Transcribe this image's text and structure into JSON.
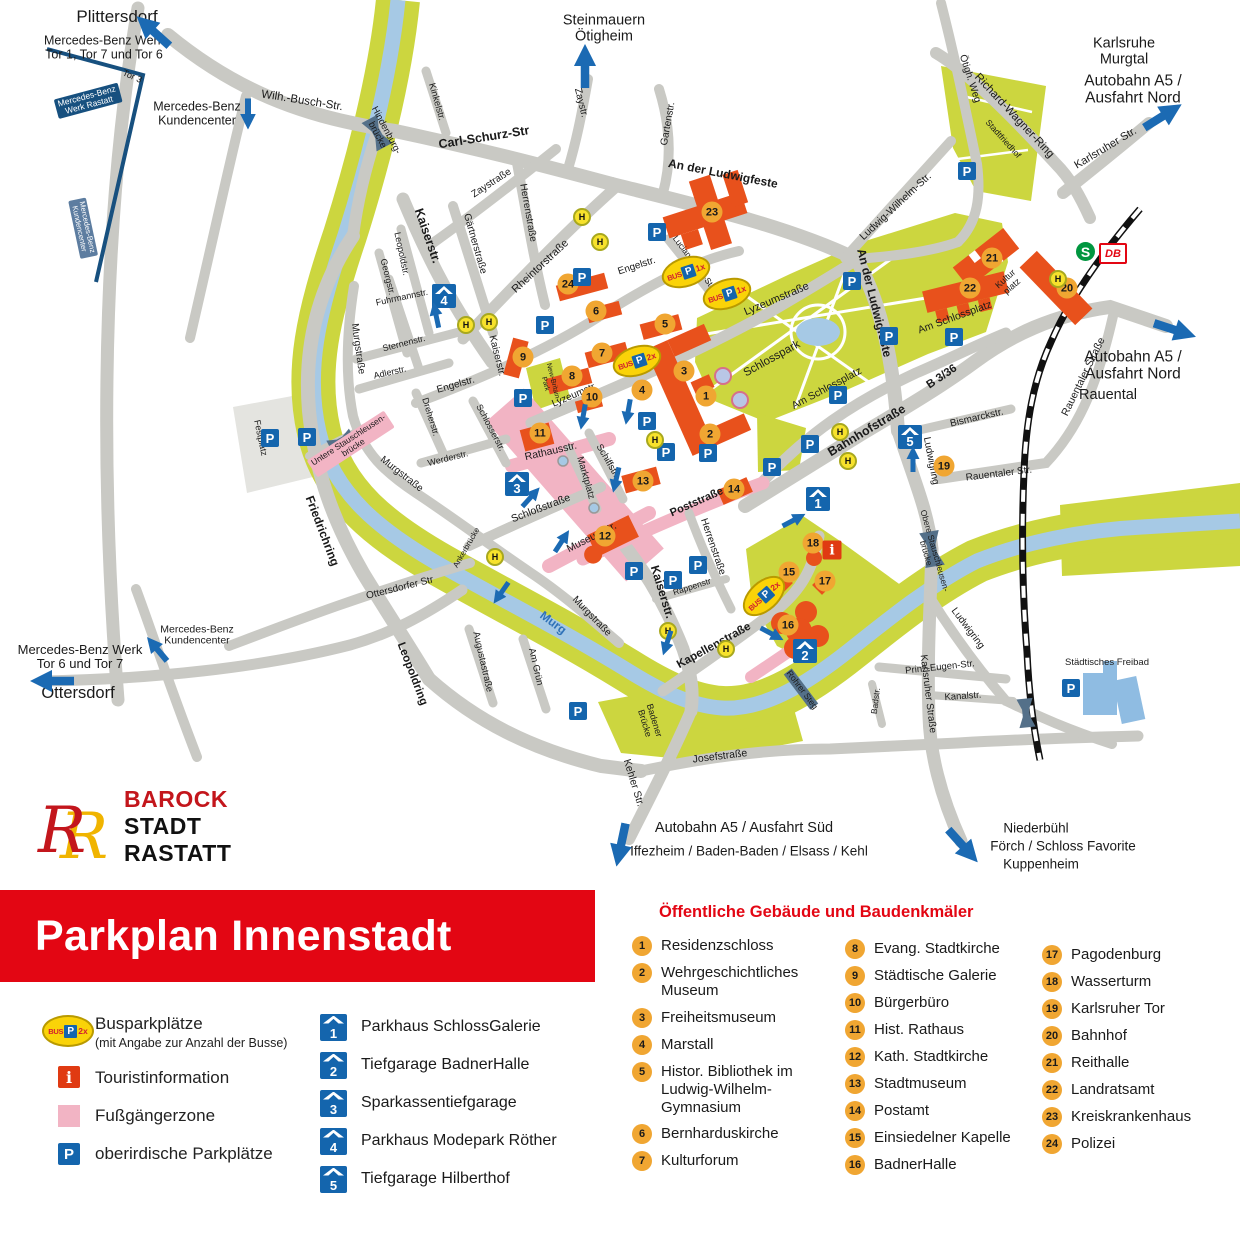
{
  "banner": {
    "title": "Parkplan Innenstadt"
  },
  "logo": {
    "line1": "BAROCK",
    "line2": "STADT",
    "line3": "RASTATT"
  },
  "legend": {
    "bus_label": "Busparkplätze",
    "bus_sub": "(mit Angabe zur Anzahl der Busse)",
    "bus_icon": {
      "bus": "BUS",
      "p": "P",
      "count": "2x"
    },
    "tourist_label": "Touristinformation",
    "tourist_glyph": "i",
    "zone_label": "Fußgängerzone",
    "parking_label": "oberirdische Parkplätze",
    "parking_glyph": "P"
  },
  "garages_legend": [
    {
      "n": "1",
      "label": "Parkhaus SchlossGalerie"
    },
    {
      "n": "2",
      "label": "Tiefgarage BadnerHalle"
    },
    {
      "n": "3",
      "label": "Sparkassentiefgarage"
    },
    {
      "n": "4",
      "label": "Parkhaus Modepark Röther"
    },
    {
      "n": "5",
      "label": "Tiefgarage Hilberthof"
    }
  ],
  "buildings": {
    "title": "Öffentliche Gebäude und Baudenkmäler",
    "col1": [
      {
        "n": "1",
        "label": "Residenzschloss"
      },
      {
        "n": "2",
        "label": "Wehrgeschichtliches Museum"
      },
      {
        "n": "3",
        "label": "Freiheitsmuseum"
      },
      {
        "n": "4",
        "label": "Marstall"
      },
      {
        "n": "5",
        "label": "Histor. Bibliothek im Ludwig-Wilhelm-Gymnasium"
      },
      {
        "n": "6",
        "label": "Bernharduskirche"
      },
      {
        "n": "7",
        "label": "Kulturforum"
      }
    ],
    "col2": [
      {
        "n": "8",
        "label": "Evang. Stadtkirche"
      },
      {
        "n": "9",
        "label": "Städtische Galerie"
      },
      {
        "n": "10",
        "label": "Bürgerbüro"
      },
      {
        "n": "11",
        "label": "Hist. Rathaus"
      },
      {
        "n": "12",
        "label": "Kath. Stadtkirche"
      },
      {
        "n": "13",
        "label": "Stadtmuseum"
      },
      {
        "n": "14",
        "label": "Postamt"
      },
      {
        "n": "15",
        "label": "Einsiedelner Kapelle"
      },
      {
        "n": "16",
        "label": "BadnerHalle"
      }
    ],
    "col3": [
      {
        "n": "17",
        "label": "Pagodenburg"
      },
      {
        "n": "18",
        "label": "Wasserturm"
      },
      {
        "n": "19",
        "label": "Karlsruher Tor"
      },
      {
        "n": "20",
        "label": "Bahnhof"
      },
      {
        "n": "21",
        "label": "Reithalle"
      },
      {
        "n": "22",
        "label": "Landratsamt"
      },
      {
        "n": "23",
        "label": "Kreiskrankenhaus"
      },
      {
        "n": "24",
        "label": "Polizei"
      }
    ]
  },
  "map": {
    "colors": {
      "road": "#c9c9c4",
      "green": "#ccd63f",
      "river": "#a6c9e5",
      "building": "#e8511c",
      "pedestrian": "#f2b4c4",
      "blue": "#1465ad",
      "poi": "#f0a632",
      "banner_red": "#e30613"
    },
    "icons": {
      "p": "P",
      "h": "H"
    },
    "transit": {
      "sbahn": "S",
      "db": "DB"
    },
    "info_icon": {
      "x": 832,
      "y": 550,
      "glyph": "i"
    },
    "labels": [
      {
        "t": "Plittersdorf",
        "x": 117,
        "y": 17,
        "s": 17
      },
      {
        "t": "Mercedes-Benz Werk\nTor 1, Tor 7 und Tor 6",
        "x": 104,
        "y": 48,
        "s": 12.5
      },
      {
        "t": "Steinmauern\nÖtigheim",
        "x": 604,
        "y": 29,
        "s": 14.5
      },
      {
        "t": "Karlsruhe\nMurgtal",
        "x": 1124,
        "y": 52,
        "s": 14.5
      },
      {
        "t": "Autobahn A5 /\nAusfahrt Nord",
        "x": 1133,
        "y": 90,
        "s": 15.5
      },
      {
        "t": "Autobahn A5 /\nAusfahrt Nord",
        "x": 1133,
        "y": 366,
        "s": 15.5
      },
      {
        "t": "Rauental",
        "x": 1108,
        "y": 396,
        "s": 14.5
      },
      {
        "t": "Mercedes-Benz\nKundencenter",
        "x": 197,
        "y": 114,
        "s": 12.5
      },
      {
        "t": "Mercedes-Benz\nKundencenter",
        "x": 197,
        "y": 636,
        "s": 10.5
      },
      {
        "t": "Mercedes-Benz Werk\nTor 6 und Tor 7",
        "x": 80,
        "y": 657,
        "s": 13
      },
      {
        "t": "Ottersdorf",
        "x": 78,
        "y": 694,
        "s": 16.5
      },
      {
        "t": "Autobahn A5 / Ausfahrt Süd",
        "x": 744,
        "y": 829,
        "s": 14.5
      },
      {
        "t": "Iffezheim / Baden-Baden / Elsass / Kehl",
        "x": 749,
        "y": 852,
        "s": 13.5
      },
      {
        "t": "Niederbühl",
        "x": 1036,
        "y": 829,
        "s": 13.5
      },
      {
        "t": "Förch / Schloss Favorite",
        "x": 1063,
        "y": 847,
        "s": 13.5
      },
      {
        "t": "Kuppenheim",
        "x": 1041,
        "y": 865,
        "s": 13.5
      },
      {
        "t": "Tor 3",
        "x": 132,
        "y": 77,
        "r": 24,
        "s": 9
      },
      {
        "t": "Mercedes-Benz\nWerk Rastatt",
        "x": 88,
        "y": 101,
        "r": -15,
        "s": 8.5,
        "c": "#fff",
        "bg": "#17507f"
      },
      {
        "t": "Mercedes-Benz\nKundencenter",
        "x": 83,
        "y": 228,
        "r": 78,
        "s": 7.5,
        "c": "#fff",
        "bg": "#5d7da0"
      },
      {
        "t": "Wilh.-Busch-Str.",
        "x": 302,
        "y": 101,
        "r": 9,
        "s": 11.5
      },
      {
        "t": "Carl-Schurz-Str",
        "x": 484,
        "y": 138,
        "r": -9,
        "s": 12.5,
        "b": 1
      },
      {
        "t": "Hindenburg-\nbrücke",
        "x": 381,
        "y": 133,
        "r": 62,
        "s": 9.5
      },
      {
        "t": "Kinkelstr.",
        "x": 436,
        "y": 102,
        "r": 74,
        "s": 9.5
      },
      {
        "t": "Zaystr.",
        "x": 580,
        "y": 103,
        "r": 76,
        "s": 10
      },
      {
        "t": "Zaystraße",
        "x": 492,
        "y": 184,
        "r": -33,
        "s": 10
      },
      {
        "t": "Gartenstr.",
        "x": 669,
        "y": 124,
        "r": -80,
        "s": 10
      },
      {
        "t": "An der Ludwigfeste",
        "x": 723,
        "y": 174,
        "r": 11,
        "s": 12,
        "b": 1
      },
      {
        "t": "An der Ludwigfeste",
        "x": 874,
        "y": 303,
        "r": 76,
        "s": 12,
        "b": 1
      },
      {
        "t": "Ludwig-Wilhelm-Str.",
        "x": 896,
        "y": 207,
        "r": -43,
        "s": 10.5
      },
      {
        "t": "Richard-Wagner-Ring",
        "x": 1014,
        "y": 116,
        "r": 47,
        "s": 11.5
      },
      {
        "t": "Ötigh. Weg",
        "x": 969,
        "y": 79,
        "r": 72,
        "s": 10
      },
      {
        "t": "Stadtfriedhof",
        "x": 1003,
        "y": 139,
        "r": 48,
        "s": 8.5
      },
      {
        "t": "Karlsruher Str.",
        "x": 1106,
        "y": 149,
        "r": -31,
        "s": 11
      },
      {
        "t": "Lyzeumstraße",
        "x": 777,
        "y": 300,
        "r": -23,
        "s": 11
      },
      {
        "t": "Lyzeumstr.",
        "x": 575,
        "y": 396,
        "r": -23,
        "s": 10
      },
      {
        "t": "Engelstr.",
        "x": 637,
        "y": 267,
        "r": -18,
        "s": 10
      },
      {
        "t": "Engelstr.",
        "x": 456,
        "y": 386,
        "r": -16,
        "s": 10
      },
      {
        "t": "Lucian-Reich-Str.",
        "x": 694,
        "y": 263,
        "r": 53,
        "s": 8.5
      },
      {
        "t": "Rheintorstraße",
        "x": 541,
        "y": 267,
        "r": -43,
        "s": 11
      },
      {
        "t": "Herrenstraße",
        "x": 527,
        "y": 213,
        "r": 80,
        "s": 10
      },
      {
        "t": "Herrenstraße",
        "x": 712,
        "y": 547,
        "r": 71,
        "s": 10
      },
      {
        "t": "Kaiserstr.",
        "x": 427,
        "y": 236,
        "r": 71,
        "s": 12.5,
        "b": 1
      },
      {
        "t": "Kaiserstr.",
        "x": 496,
        "y": 356,
        "r": 76,
        "s": 10
      },
      {
        "t": "Kaiserstr.",
        "x": 662,
        "y": 592,
        "r": 73,
        "s": 12,
        "b": 1
      },
      {
        "t": "Gärtnerstraße",
        "x": 474,
        "y": 244,
        "r": 74,
        "s": 10
      },
      {
        "t": "Leopoldstr.",
        "x": 401,
        "y": 254,
        "r": 78,
        "s": 9
      },
      {
        "t": "Georgstr.",
        "x": 387,
        "y": 277,
        "r": 76,
        "s": 9
      },
      {
        "t": "Fuhrmannstr.",
        "x": 402,
        "y": 298,
        "r": -12,
        "s": 9
      },
      {
        "t": "Sternenstr.",
        "x": 404,
        "y": 344,
        "r": -14,
        "s": 9
      },
      {
        "t": "Adlerstr.",
        "x": 390,
        "y": 373,
        "r": -13,
        "s": 9
      },
      {
        "t": "Dreherstr.",
        "x": 430,
        "y": 417,
        "r": 73,
        "s": 9
      },
      {
        "t": "Werderstr.",
        "x": 448,
        "y": 459,
        "r": -14,
        "s": 9
      },
      {
        "t": "Schlosserstr.",
        "x": 490,
        "y": 428,
        "r": 62,
        "s": 9
      },
      {
        "t": "Rathausstr.",
        "x": 551,
        "y": 452,
        "r": -13,
        "s": 10.5
      },
      {
        "t": "Marktplatz",
        "x": 585,
        "y": 478,
        "r": 74,
        "s": 9.5
      },
      {
        "t": "Schiffstr.",
        "x": 607,
        "y": 461,
        "r": 60,
        "s": 9.5
      },
      {
        "t": "Museumstr.",
        "x": 592,
        "y": 538,
        "r": -27,
        "s": 10.5
      },
      {
        "t": "Schloßstraße",
        "x": 541,
        "y": 509,
        "r": -21,
        "s": 10.5
      },
      {
        "t": "Murgstraße",
        "x": 357,
        "y": 349,
        "r": 82,
        "s": 10
      },
      {
        "t": "Murgstraße",
        "x": 401,
        "y": 475,
        "r": 38,
        "s": 10
      },
      {
        "t": "Murgstraße",
        "x": 591,
        "y": 617,
        "r": 46,
        "s": 10
      },
      {
        "t": "Murg",
        "x": 553,
        "y": 623,
        "r": 37,
        "s": 12,
        "b": 1,
        "c": "#2f72b8"
      },
      {
        "t": "Festplatz",
        "x": 260,
        "y": 438,
        "r": 78,
        "s": 9
      },
      {
        "t": "Untere Stauschleusen-\nbrücke",
        "x": 351,
        "y": 444,
        "r": -33,
        "s": 8.5,
        "bg": "#f2b4c4"
      },
      {
        "t": "Friedrichring",
        "x": 322,
        "y": 531,
        "r": 69,
        "s": 12,
        "b": 1
      },
      {
        "t": "Ottersdorfer Str",
        "x": 400,
        "y": 589,
        "r": -14,
        "s": 10
      },
      {
        "t": "Leopoldring",
        "x": 412,
        "y": 674,
        "r": 69,
        "s": 11.5,
        "b": 1
      },
      {
        "t": "Ankerbrücke",
        "x": 467,
        "y": 548,
        "r": -60,
        "s": 8
      },
      {
        "t": "Augustastraße",
        "x": 482,
        "y": 662,
        "r": 77,
        "s": 9.5
      },
      {
        "t": "Am Grün",
        "x": 535,
        "y": 667,
        "r": 77,
        "s": 9.5
      },
      {
        "t": "New-Britain-\nPark",
        "x": 549,
        "y": 383,
        "r": 76,
        "s": 7
      },
      {
        "t": "Badener\nBrücke",
        "x": 649,
        "y": 722,
        "r": 73,
        "s": 9
      },
      {
        "t": "Kehler Str.",
        "x": 633,
        "y": 783,
        "r": 73,
        "s": 10.5
      },
      {
        "t": "Josefstraße",
        "x": 720,
        "y": 757,
        "r": -7,
        "s": 10.5
      },
      {
        "t": "Poststraße",
        "x": 697,
        "y": 503,
        "r": -24,
        "s": 11,
        "b": 1
      },
      {
        "t": "Rappenstr",
        "x": 692,
        "y": 587,
        "r": -18,
        "s": 8.5
      },
      {
        "t": "Kapellenstraße",
        "x": 714,
        "y": 646,
        "r": -29,
        "s": 11.5,
        "b": 1
      },
      {
        "t": "Schlosspark",
        "x": 772,
        "y": 359,
        "r": -29,
        "s": 11.5
      },
      {
        "t": "Am Schlossplatz",
        "x": 827,
        "y": 389,
        "r": -28,
        "s": 10.5
      },
      {
        "t": "Am Schlossplatz",
        "x": 955,
        "y": 318,
        "r": -20,
        "s": 10.5
      },
      {
        "t": "Bahnhofstraße",
        "x": 867,
        "y": 431,
        "r": -31,
        "s": 12.5,
        "b": 1
      },
      {
        "t": "B 3/36",
        "x": 942,
        "y": 377,
        "r": -34,
        "s": 11.5,
        "b": 1
      },
      {
        "t": "Kultur\nplatz",
        "x": 1009,
        "y": 283,
        "r": -42,
        "s": 9
      },
      {
        "t": "Bismarckstr.",
        "x": 977,
        "y": 419,
        "r": -13,
        "s": 10
      },
      {
        "t": "Ludwigring",
        "x": 930,
        "y": 461,
        "r": 79,
        "s": 10
      },
      {
        "t": "Ludwigring",
        "x": 967,
        "y": 629,
        "r": 53,
        "s": 10
      },
      {
        "t": "Karlsruher Straße",
        "x": 927,
        "y": 694,
        "r": 83,
        "s": 10
      },
      {
        "t": "Rauentaler Str.",
        "x": 999,
        "y": 475,
        "r": -7,
        "s": 10
      },
      {
        "t": "Rauentaler Straße",
        "x": 1084,
        "y": 377,
        "r": -64,
        "s": 10.5
      },
      {
        "t": "Obere Stauschleusen-\nbrücke",
        "x": 930,
        "y": 552,
        "r": 74,
        "s": 8.5
      },
      {
        "t": "Prinz-Eugen-Str.",
        "x": 940,
        "y": 668,
        "r": -6,
        "s": 9.5
      },
      {
        "t": "Kanalstr.",
        "x": 963,
        "y": 697,
        "r": -4,
        "s": 9.5
      },
      {
        "t": "Badstr.",
        "x": 876,
        "y": 701,
        "r": -83,
        "s": 8.5
      },
      {
        "t": "Rohrer Steg",
        "x": 802,
        "y": 690,
        "r": 53,
        "s": 8.5
      },
      {
        "t": "Städtisches Freibad",
        "x": 1107,
        "y": 663,
        "s": 9.5
      }
    ],
    "poi": [
      {
        "n": "1",
        "x": 706,
        "y": 396
      },
      {
        "n": "2",
        "x": 710,
        "y": 434
      },
      {
        "n": "3",
        "x": 684,
        "y": 371
      },
      {
        "n": "4",
        "x": 642,
        "y": 390
      },
      {
        "n": "5",
        "x": 665,
        "y": 324
      },
      {
        "n": "6",
        "x": 596,
        "y": 311
      },
      {
        "n": "7",
        "x": 602,
        "y": 353
      },
      {
        "n": "8",
        "x": 572,
        "y": 376
      },
      {
        "n": "9",
        "x": 523,
        "y": 357
      },
      {
        "n": "10",
        "x": 592,
        "y": 397
      },
      {
        "n": "11",
        "x": 540,
        "y": 433
      },
      {
        "n": "12",
        "x": 605,
        "y": 536
      },
      {
        "n": "13",
        "x": 643,
        "y": 481
      },
      {
        "n": "14",
        "x": 734,
        "y": 489
      },
      {
        "n": "15",
        "x": 789,
        "y": 572
      },
      {
        "n": "16",
        "x": 788,
        "y": 625
      },
      {
        "n": "17",
        "x": 825,
        "y": 581
      },
      {
        "n": "18",
        "x": 813,
        "y": 543
      },
      {
        "n": "19",
        "x": 944,
        "y": 466
      },
      {
        "n": "20",
        "x": 1067,
        "y": 288
      },
      {
        "n": "21",
        "x": 992,
        "y": 258
      },
      {
        "n": "22",
        "x": 970,
        "y": 288
      },
      {
        "n": "23",
        "x": 712,
        "y": 212
      },
      {
        "n": "24",
        "x": 568,
        "y": 284
      }
    ],
    "p_icons": [
      [
        270,
        438
      ],
      [
        307,
        437
      ],
      [
        545,
        325
      ],
      [
        582,
        277
      ],
      [
        657,
        232
      ],
      [
        852,
        281
      ],
      [
        967,
        171
      ],
      [
        889,
        336
      ],
      [
        954,
        337
      ],
      [
        838,
        395
      ],
      [
        810,
        444
      ],
      [
        772,
        467
      ],
      [
        647,
        421
      ],
      [
        666,
        452
      ],
      [
        708,
        453
      ],
      [
        634,
        571
      ],
      [
        673,
        580
      ],
      [
        698,
        565
      ],
      [
        578,
        711
      ],
      [
        1071,
        688
      ],
      [
        523,
        398
      ]
    ],
    "h_icons": [
      [
        582,
        217
      ],
      [
        600,
        242
      ],
      [
        466,
        325
      ],
      [
        489,
        322
      ],
      [
        655,
        440
      ],
      [
        495,
        557
      ],
      [
        668,
        631
      ],
      [
        726,
        649
      ],
      [
        840,
        432
      ],
      [
        848,
        461
      ],
      [
        1058,
        279
      ]
    ],
    "garage_icons": [
      {
        "n": "1",
        "x": 818,
        "y": 499
      },
      {
        "n": "2",
        "x": 805,
        "y": 651
      },
      {
        "n": "3",
        "x": 517,
        "y": 484
      },
      {
        "n": "4",
        "x": 444,
        "y": 296
      },
      {
        "n": "5",
        "x": 910,
        "y": 437
      }
    ],
    "bus_parks": [
      {
        "x": 686,
        "y": 272,
        "r": -18,
        "count": "1x"
      },
      {
        "x": 727,
        "y": 294,
        "r": -18,
        "count": "1x"
      },
      {
        "x": 637,
        "y": 361,
        "r": -18,
        "count": "2x"
      },
      {
        "x": 764,
        "y": 596,
        "r": -42,
        "count": "2x"
      }
    ],
    "arrows": [
      [
        153,
        31,
        -138,
        1.7
      ],
      [
        585,
        66,
        -90,
        1.7
      ],
      [
        1163,
        116,
        -32,
        1.7
      ],
      [
        1175,
        330,
        18,
        1.7
      ],
      [
        52,
        681,
        180,
        1.7
      ],
      [
        621,
        845,
        102,
        1.7
      ],
      [
        963,
        846,
        48,
        1.7
      ],
      [
        248,
        114,
        90,
        1.2
      ],
      [
        157,
        649,
        -130,
        1.2
      ],
      [
        436,
        315,
        -102,
        1
      ],
      [
        531,
        497,
        -48,
        1
      ],
      [
        794,
        520,
        -28,
        1
      ],
      [
        772,
        634,
        28,
        1
      ],
      [
        913,
        459,
        -90,
        1
      ],
      [
        583,
        417,
        100,
        1
      ],
      [
        616,
        480,
        103,
        1
      ],
      [
        667,
        643,
        108,
        1
      ],
      [
        562,
        541,
        -57,
        1
      ],
      [
        501,
        593,
        125,
        1
      ],
      [
        628,
        412,
        100,
        1
      ]
    ]
  }
}
